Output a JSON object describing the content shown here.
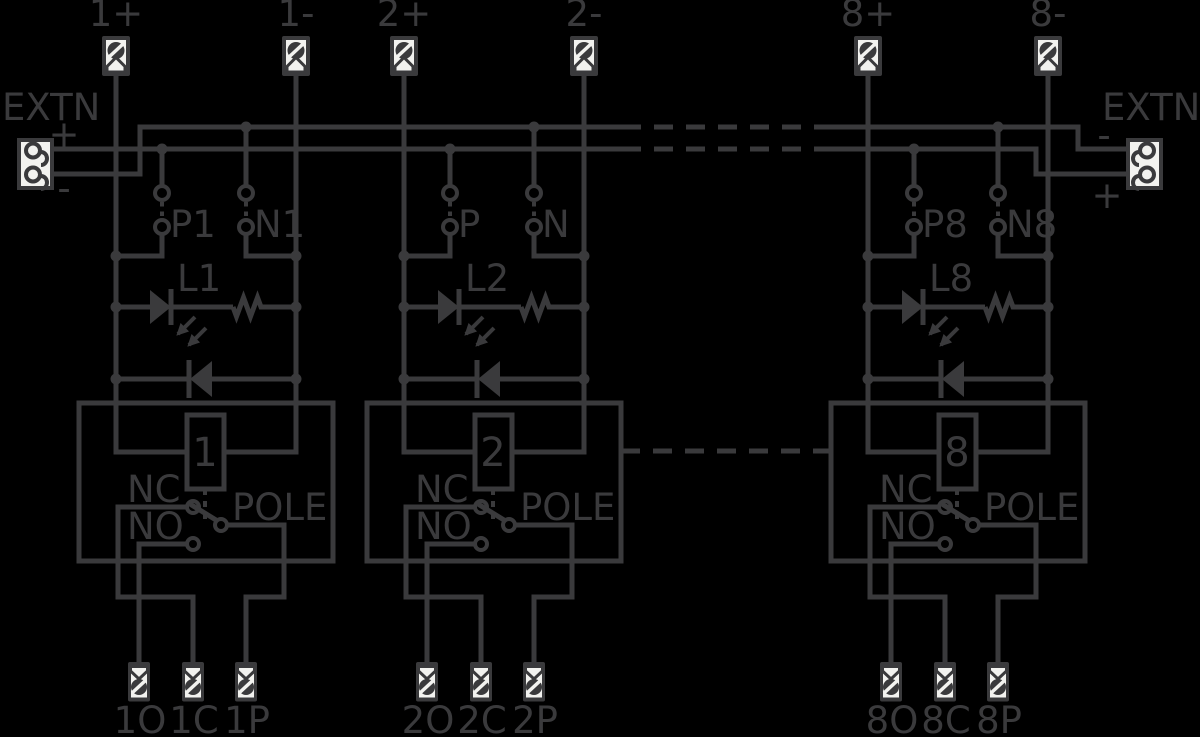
{
  "colors": {
    "background": "#000000",
    "line": "#3a3a3c",
    "panel": "#f2f2ef"
  },
  "extn_left": {
    "label": "EXTN",
    "plus": "+",
    "minus": "-"
  },
  "extn_right": {
    "label": "EXTN",
    "minus": "-",
    "plus": "+"
  },
  "channels": [
    {
      "input_plus": "1+",
      "input_minus": "1-",
      "jumper_p": "P1",
      "jumper_n": "N1",
      "led": "L1",
      "coil": "1",
      "nc": "NC",
      "no": "NO",
      "pole": "POLE",
      "out_o": "1O",
      "out_c": "1C",
      "out_p": "1P"
    },
    {
      "input_plus": "2+",
      "input_minus": "2-",
      "jumper_p": "P",
      "jumper_n": "N",
      "led": "L2",
      "coil": "2",
      "nc": "NC",
      "no": "NO",
      "pole": "POLE",
      "out_o": "2O",
      "out_c": "2C",
      "out_p": "2P"
    },
    {
      "input_plus": "8+",
      "input_minus": "8-",
      "jumper_p": "P8",
      "jumper_n": "N8",
      "led": "L8",
      "coil": "8",
      "nc": "NC",
      "no": "NO",
      "pole": "POLE",
      "out_o": "8O",
      "out_c": "8C",
      "out_p": "8P"
    }
  ]
}
